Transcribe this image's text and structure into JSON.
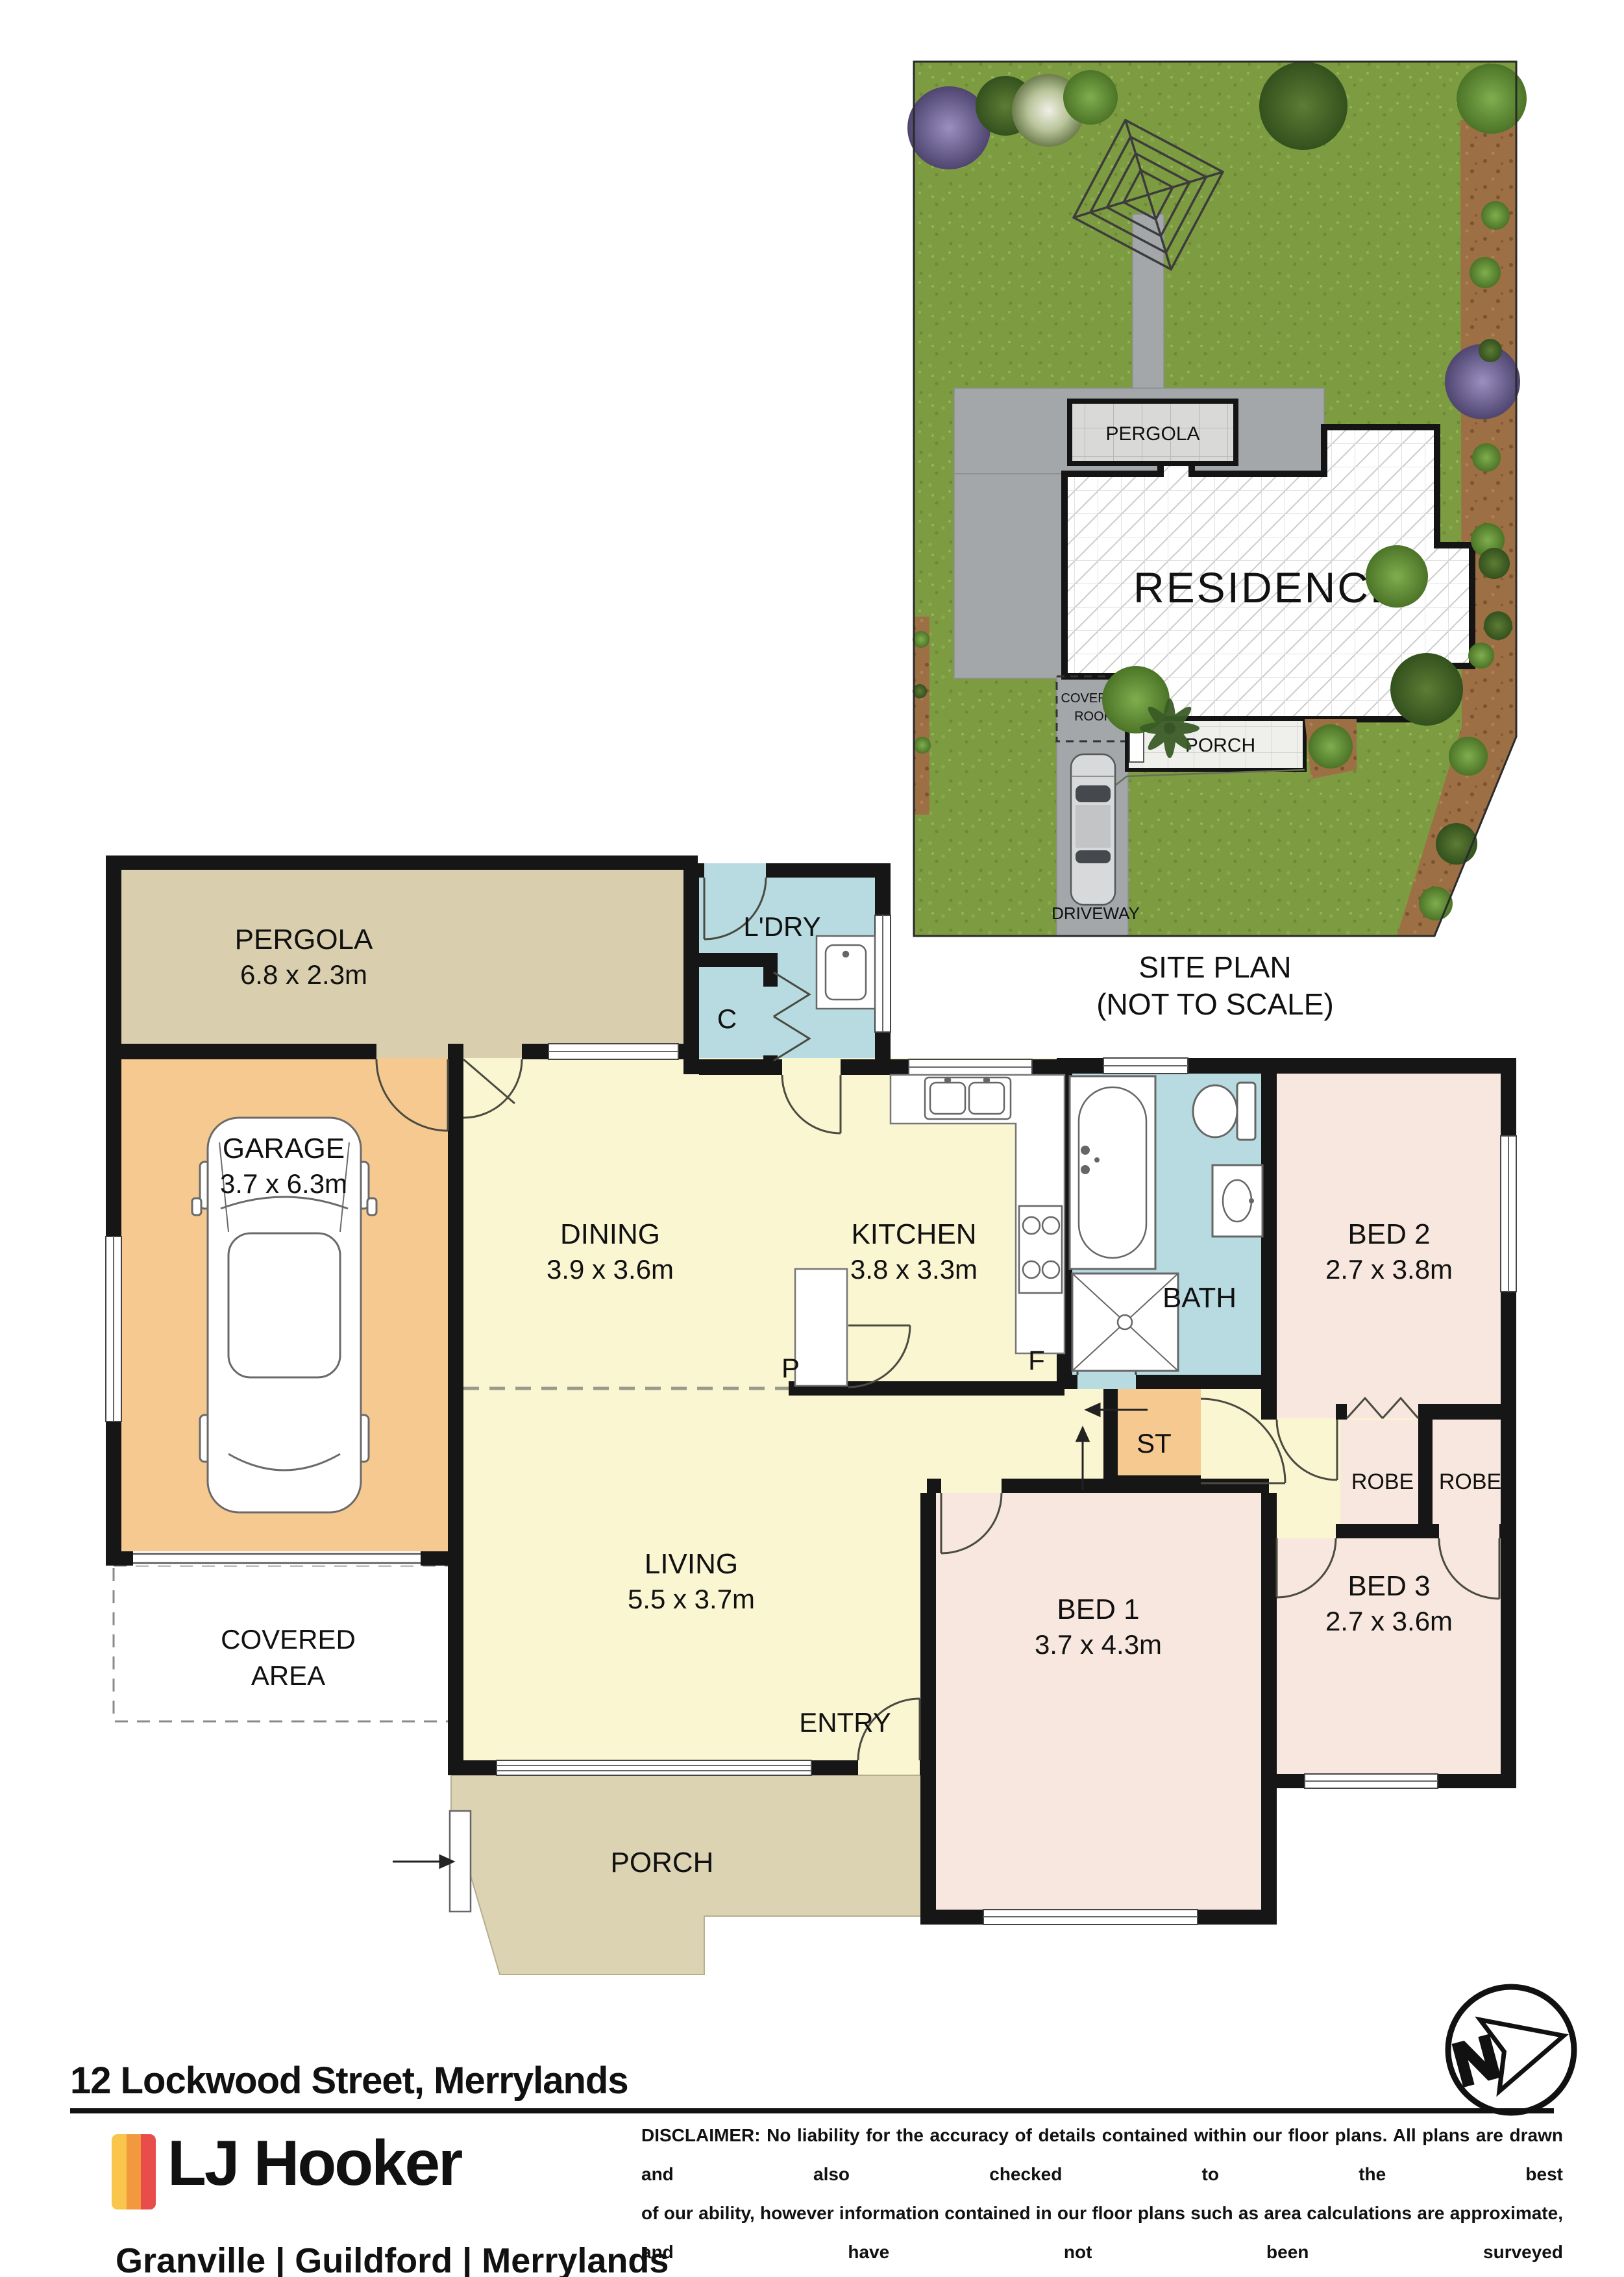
{
  "site_plan": {
    "labels": {
      "pergola": "PERGOLA",
      "residence": "RESIDENCE",
      "covered_roof_line1": "COVERED",
      "covered_roof_line2": "ROOF",
      "porch": "PORCH",
      "driveway": "DRIVEWAY"
    },
    "caption_line1": "SITE PLAN",
    "caption_line2": "(NOT TO SCALE)"
  },
  "floor_plan": {
    "labels": {
      "pergola": {
        "name": "PERGOLA",
        "dims": "6.8 x 2.3m"
      },
      "garage": {
        "name": "GARAGE",
        "dims": "3.7 x 6.3m"
      },
      "dining": {
        "name": "DINING",
        "dims": "3.9 x 3.6m"
      },
      "kitchen": {
        "name": "KITCHEN",
        "dims": "3.8 x 3.3m"
      },
      "living": {
        "name": "LIVING",
        "dims": "5.5 x 3.7m"
      },
      "bed1": {
        "name": "BED 1",
        "dims": "3.7 x 4.3m"
      },
      "bed2": {
        "name": "BED 2",
        "dims": "2.7 x 3.8m"
      },
      "bed3": {
        "name": "BED 3",
        "dims": "2.7 x 3.6m"
      },
      "laundry": "L'DRY",
      "bath": "BATH",
      "entry": "ENTRY",
      "porch": "PORCH",
      "covered_line1": "COVERED",
      "covered_line2": "AREA",
      "storage": "ST",
      "robe": "ROBE",
      "cupboard": "C",
      "pantry": "P",
      "fridge": "F"
    }
  },
  "footer": {
    "address": "12 Lockwood Street, Merrylands",
    "brand": "LJ Hooker",
    "offices": "Granville | Guildford | Merrylands",
    "disclaimer_lines": [
      "DISCLAIMER: No liability for the accuracy of details contained within our floor plans. All plans are drawn and also checked to the best",
      "of our ability, however information contained in our floor plans such as area calculations are approximate, and have not been surveyed",
      "or drawn to scale. Our floor plans are for representational purposes only and should be used as such. Do not attempt to refer to our",
      "floor plans for structural or detailed information."
    ],
    "compass_n": "N"
  },
  "colors": {
    "wall": "#161616",
    "room_yellow": "#FAF6D2",
    "room_blue": "#B7DBE1",
    "room_pink": "#F8E7DE",
    "room_orange": "#F6C990",
    "pergola_tan": "#D9CFAE",
    "porch_tan": "#DCD3B3",
    "grass_green": "#7D9B41",
    "paving_grey": "#A3A7AA",
    "dirt_brown": "#9C6F45",
    "brand_yellow": "#F9C64B",
    "brand_orange": "#F2993F",
    "brand_red": "#E84D4B"
  }
}
